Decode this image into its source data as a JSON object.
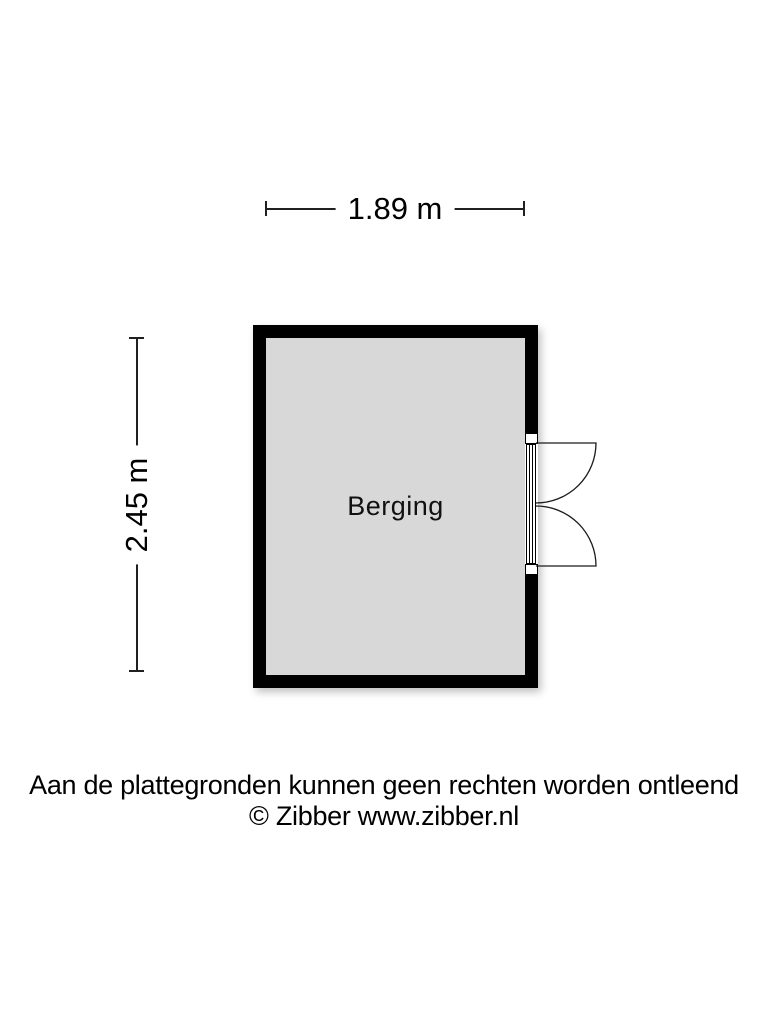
{
  "floorplan": {
    "dimensions": {
      "width_label": "1.89 m",
      "height_label": "2.45 m"
    },
    "room": {
      "label": "Berging"
    },
    "door": {
      "type": "double-swing-door",
      "location": "right-wall"
    },
    "colors": {
      "wall": "#000000",
      "room_fill": "#d8d8d8",
      "background": "#ffffff",
      "text": "#000000",
      "dimension_line": "#202020"
    }
  },
  "footer": {
    "line1": "Aan de plattegronden kunnen geen rechten worden ontleend",
    "line2": "© Zibber www.zibber.nl"
  }
}
